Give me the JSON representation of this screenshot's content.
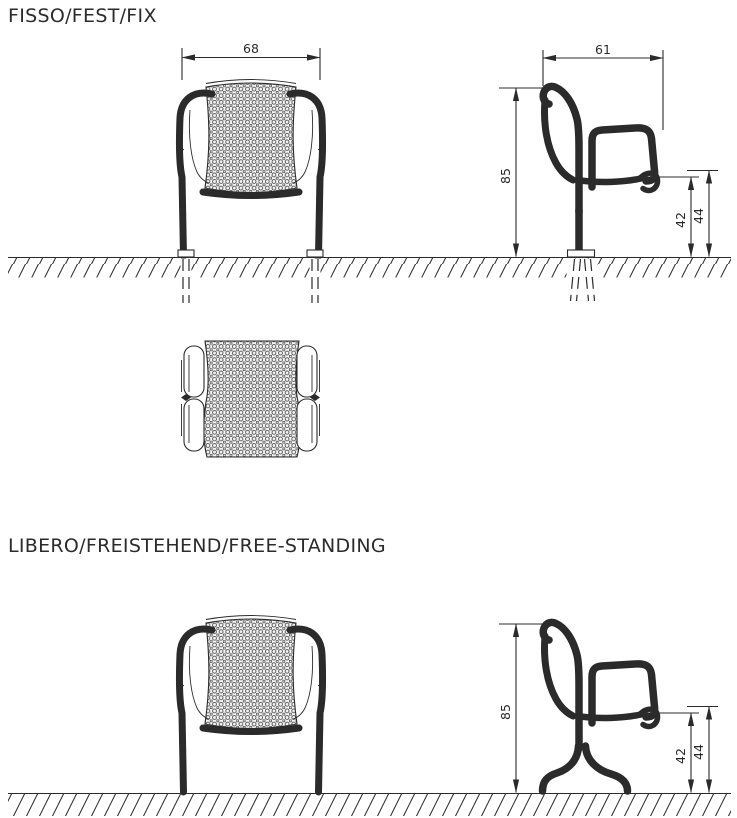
{
  "style": {
    "line_color": "#2b2b2b",
    "background": "#ffffff"
  },
  "sections": [
    {
      "id": "fixed",
      "title": "FISSO/FEST/FIX",
      "dims": {
        "width": "68",
        "depth": "61",
        "height": "85",
        "seat_height_rear": "42",
        "seat_height_front": "44"
      }
    },
    {
      "id": "free_standing",
      "title": "LIBERO/FREISTEHEND/FREE-STANDING",
      "dims": {
        "height": "85",
        "seat_height_rear": "42",
        "seat_height_front": "44"
      }
    }
  ]
}
